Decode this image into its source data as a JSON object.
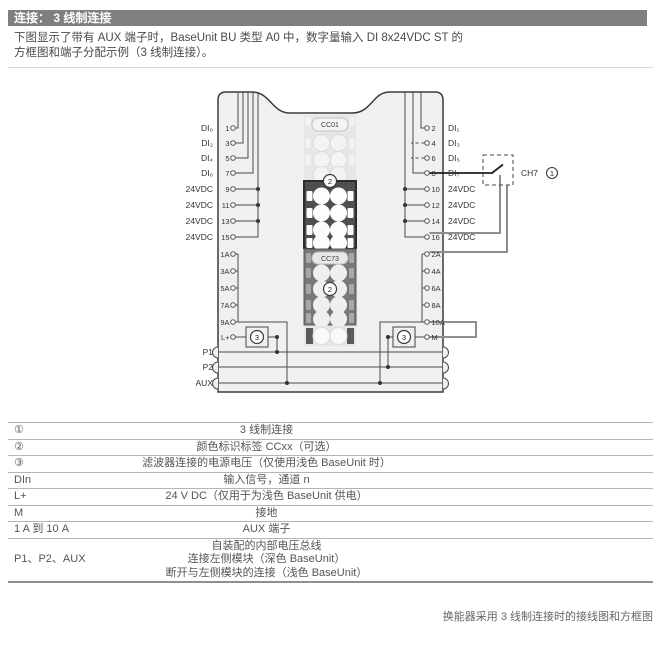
{
  "header": {
    "title": "连接： 3 线制连接"
  },
  "intro": {
    "text": "下图显示了带有 AUX 端子时，BaseUnit BU 类型 A0 中，数字量输入 DI 8x24VDC ST 的\n方框图和端子分配示例（3 线制连接）。"
  },
  "diagram": {
    "left_rows": [
      {
        "label": "DI₀",
        "terminal": "1"
      },
      {
        "label": "DI₂",
        "terminal": "3"
      },
      {
        "label": "DI₄",
        "terminal": "5"
      },
      {
        "label": "DI₆",
        "terminal": "7"
      },
      {
        "label": "24VDC",
        "terminal": "9"
      },
      {
        "label": "24VDC",
        "terminal": "11"
      },
      {
        "label": "24VDC",
        "terminal": "13"
      },
      {
        "label": "24VDC",
        "terminal": "15"
      }
    ],
    "right_rows": [
      {
        "terminal": "2",
        "label": "DI₁"
      },
      {
        "terminal": "4",
        "label": "DI₃"
      },
      {
        "terminal": "6",
        "label": "DI₅"
      },
      {
        "terminal": "8",
        "label": "DI₇"
      },
      {
        "terminal": "10",
        "label": "24VDC"
      },
      {
        "terminal": "12",
        "label": "24VDC"
      },
      {
        "terminal": "14",
        "label": "24VDC"
      },
      {
        "terminal": "16",
        "label": "24VDC"
      }
    ],
    "left_aux": [
      "1A",
      "3A",
      "5A",
      "7A",
      "9A"
    ],
    "right_aux": [
      "2A",
      "4A",
      "6A",
      "8A",
      "10A"
    ],
    "left_power": "L+",
    "right_power": "M",
    "bus_labels": [
      "P1",
      "P2",
      "AUX"
    ],
    "strip": {
      "top_label": "CC01",
      "bottom_label": "CC73"
    },
    "badge1": "1",
    "badge2": "2",
    "badge3": "3",
    "channel_label": "CH7"
  },
  "legend": {
    "rows": [
      {
        "term": "①",
        "desc": "3 线制连接"
      },
      {
        "term": "②",
        "desc": "颜色标识标签 CCxx（可选）"
      },
      {
        "term": "③",
        "desc": "滤波器连接的电源电压（仅使用浅色 BaseUnit 时）"
      },
      {
        "term": "DIn",
        "desc": "输入信号，通道 n"
      },
      {
        "term": "L+",
        "desc": "24 V DC（仅用于为浅色 BaseUnit 供电）"
      },
      {
        "term": "M",
        "desc": "接地"
      },
      {
        "term": "1 A 到 10 A",
        "desc": "AUX 端子"
      },
      {
        "term": "P1、P2、AUX",
        "desc": "自装配的内部电压总线\n连接左侧模块（深色 BaseUnit）\n断开与左侧模块的连接（浅色 BaseUnit）"
      }
    ]
  },
  "caption": "换能器采用 3 线制连接时的接线图和方框图",
  "colors": {
    "header_bg": "#7f7f7f",
    "unit_fill": "#f0f0f0",
    "outline": "#3c3c3c",
    "wire": "#4a4a4a",
    "signal_wire": "#1f1f1f",
    "sensor_wire": "#8d8d8d",
    "strip_dark": "#4f4f4f",
    "strip_mid": "#777777",
    "strip_light": "#e7e7e7"
  }
}
